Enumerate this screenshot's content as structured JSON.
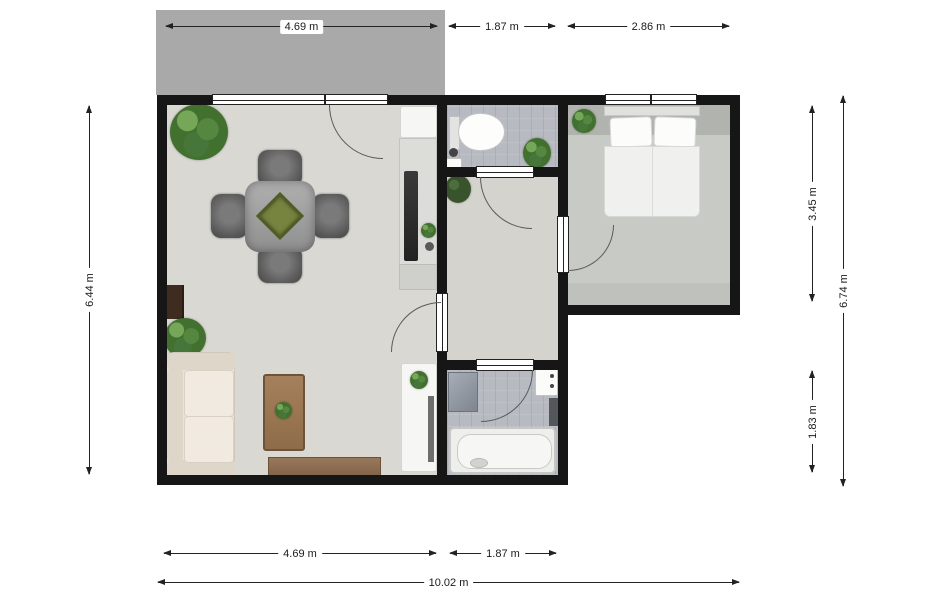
{
  "plan": {
    "type": "2D apartment floor plan, top-down view",
    "unit": "m"
  },
  "dimensions": {
    "top": [
      {
        "label": "4.69 m"
      },
      {
        "label": "1.87 m"
      },
      {
        "label": "2.86 m"
      }
    ],
    "left": [
      {
        "label": "6.44 m"
      }
    ],
    "right": [
      {
        "label": "3.45 m"
      },
      {
        "label": "6.74 m"
      },
      {
        "label": "1.83 m"
      }
    ],
    "bottom": [
      {
        "label": "4.69 m"
      },
      {
        "label": "1.87 m"
      },
      {
        "label": "10.02 m"
      }
    ]
  },
  "rooms": [
    {
      "name": "terrace"
    },
    {
      "name": "living-room-with-kitchen"
    },
    {
      "name": "toilet-room"
    },
    {
      "name": "hallway"
    },
    {
      "name": "bathroom"
    },
    {
      "name": "bedroom"
    }
  ],
  "furniture": [
    "sofa",
    "coffee-table",
    "sideboard",
    "fireplace-cabinet",
    "dining-table",
    "four-chairs",
    "planter-centerpiece",
    "kitchen-counter",
    "cooktop",
    "kitchen-appliance",
    "desk",
    "toilet",
    "washbasin",
    "bathtub",
    "shower-cabinet",
    "washing-machine",
    "double-bed",
    "pillows",
    "potted-plants"
  ],
  "colors": {
    "wall": "#161616",
    "terrace": "#a9a9a9",
    "living_floor": "#d9d8d3",
    "bedroom_floor": "#c8cac5",
    "tile_floor": "#b7bac1",
    "plant_green": "#4a7736",
    "wood_brown": "#8d6e4f",
    "sofa_cream": "#e9e3da",
    "dimension_text": "#1a1a1a",
    "background": "#ffffff"
  }
}
